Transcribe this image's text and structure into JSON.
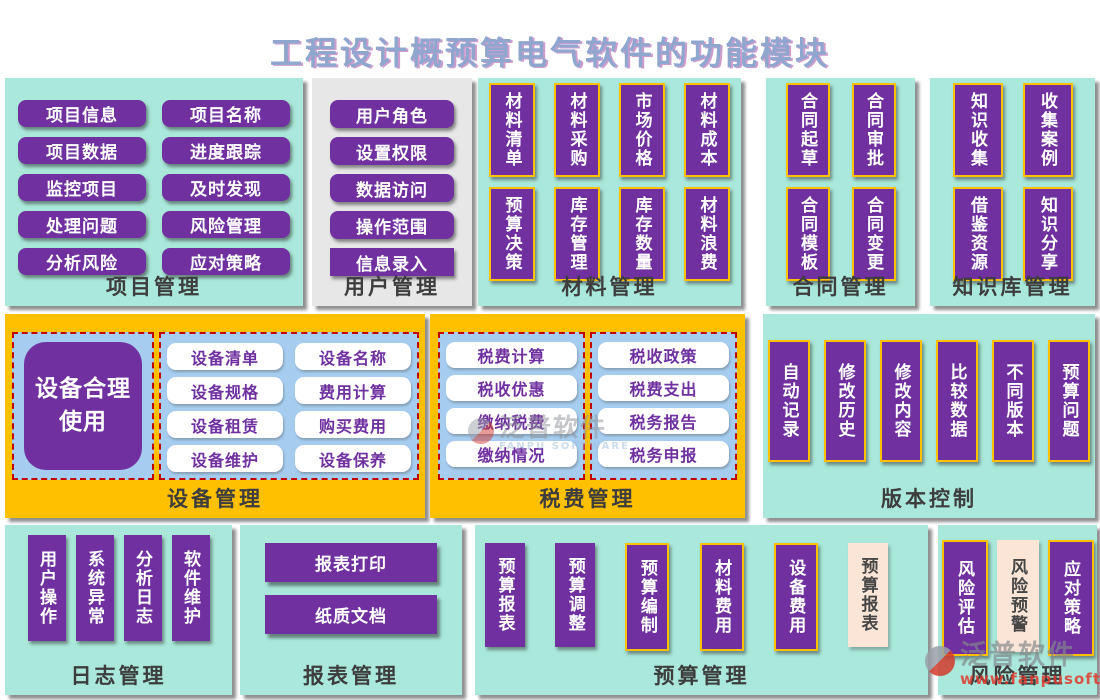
{
  "title": "工程设计概预算电气软件的功能模块",
  "colors": {
    "teal_panel": "#a9e8da",
    "gray_panel": "#e8e7e7",
    "orange_panel": "#ffc000",
    "button_purple": "#7030a0",
    "button_cream": "#fbe5d6",
    "blue_container": "#a6cdf0",
    "gold_border": "#ffc000",
    "red_dashed_border": "#c00000",
    "title_color": "#8fa7cf"
  },
  "panels": {
    "project": {
      "label": "项目管理",
      "items": [
        "项目信息",
        "项目名称",
        "项目数据",
        "进度跟踪",
        "监控项目",
        "及时发现",
        "处理问题",
        "风险管理",
        "分析风险",
        "应对策略"
      ]
    },
    "user": {
      "label": "用户管理",
      "items": [
        "用户角色",
        "设置权限",
        "数据访问",
        "操作范围",
        "信息录入"
      ]
    },
    "material": {
      "label": "材料管理",
      "items": [
        "材料清单",
        "材料采购",
        "市场价格",
        "材料成本",
        "预算决策",
        "库存管理",
        "库存数量",
        "材料浪费"
      ]
    },
    "contract": {
      "label": "合同管理",
      "items": [
        "合同起草",
        "合同审批",
        "合同模板",
        "合同变更"
      ]
    },
    "knowledge": {
      "label": "知识库管理",
      "items": [
        "知识收集",
        "收集案例",
        "借鉴资源",
        "知识分享"
      ]
    },
    "equipment": {
      "label": "设备管理",
      "feature": "设备合理使用",
      "items": [
        "设备清单",
        "设备名称",
        "设备规格",
        "费用计算",
        "设备租赁",
        "购买费用",
        "设备维护",
        "设备保养"
      ]
    },
    "tax": {
      "label": "税费管理",
      "left": [
        "税费计算",
        "税收优惠",
        "缴纳税费",
        "缴纳情况"
      ],
      "right": [
        "税收政策",
        "税费支出",
        "税务报告",
        "税务申报"
      ]
    },
    "version": {
      "label": "版本控制",
      "items": [
        "自动记录",
        "修改历史",
        "修改内容",
        "比较数据",
        "不同版本",
        "预算问题"
      ]
    },
    "log": {
      "label": "日志管理",
      "items": [
        "用户操作",
        "系统异常",
        "分析日志",
        "软件维护"
      ]
    },
    "report": {
      "label": "报表管理",
      "items": [
        "报表打印",
        "纸质文档"
      ]
    },
    "budget": {
      "label": "预算管理",
      "items": [
        "预算报表",
        "预算调整",
        "预算编制",
        "材料费用",
        "设备费用",
        "预算报表"
      ]
    },
    "risk": {
      "label": "风险管理",
      "items": [
        "风险评估",
        "风险预警",
        "应对策略"
      ]
    }
  },
  "watermarks": {
    "center": {
      "brand": "泛普软件",
      "sub": "FANPU SOFTWARE"
    },
    "corner": {
      "brand": "泛普软件",
      "url": "www.fanpusoft.com"
    }
  }
}
